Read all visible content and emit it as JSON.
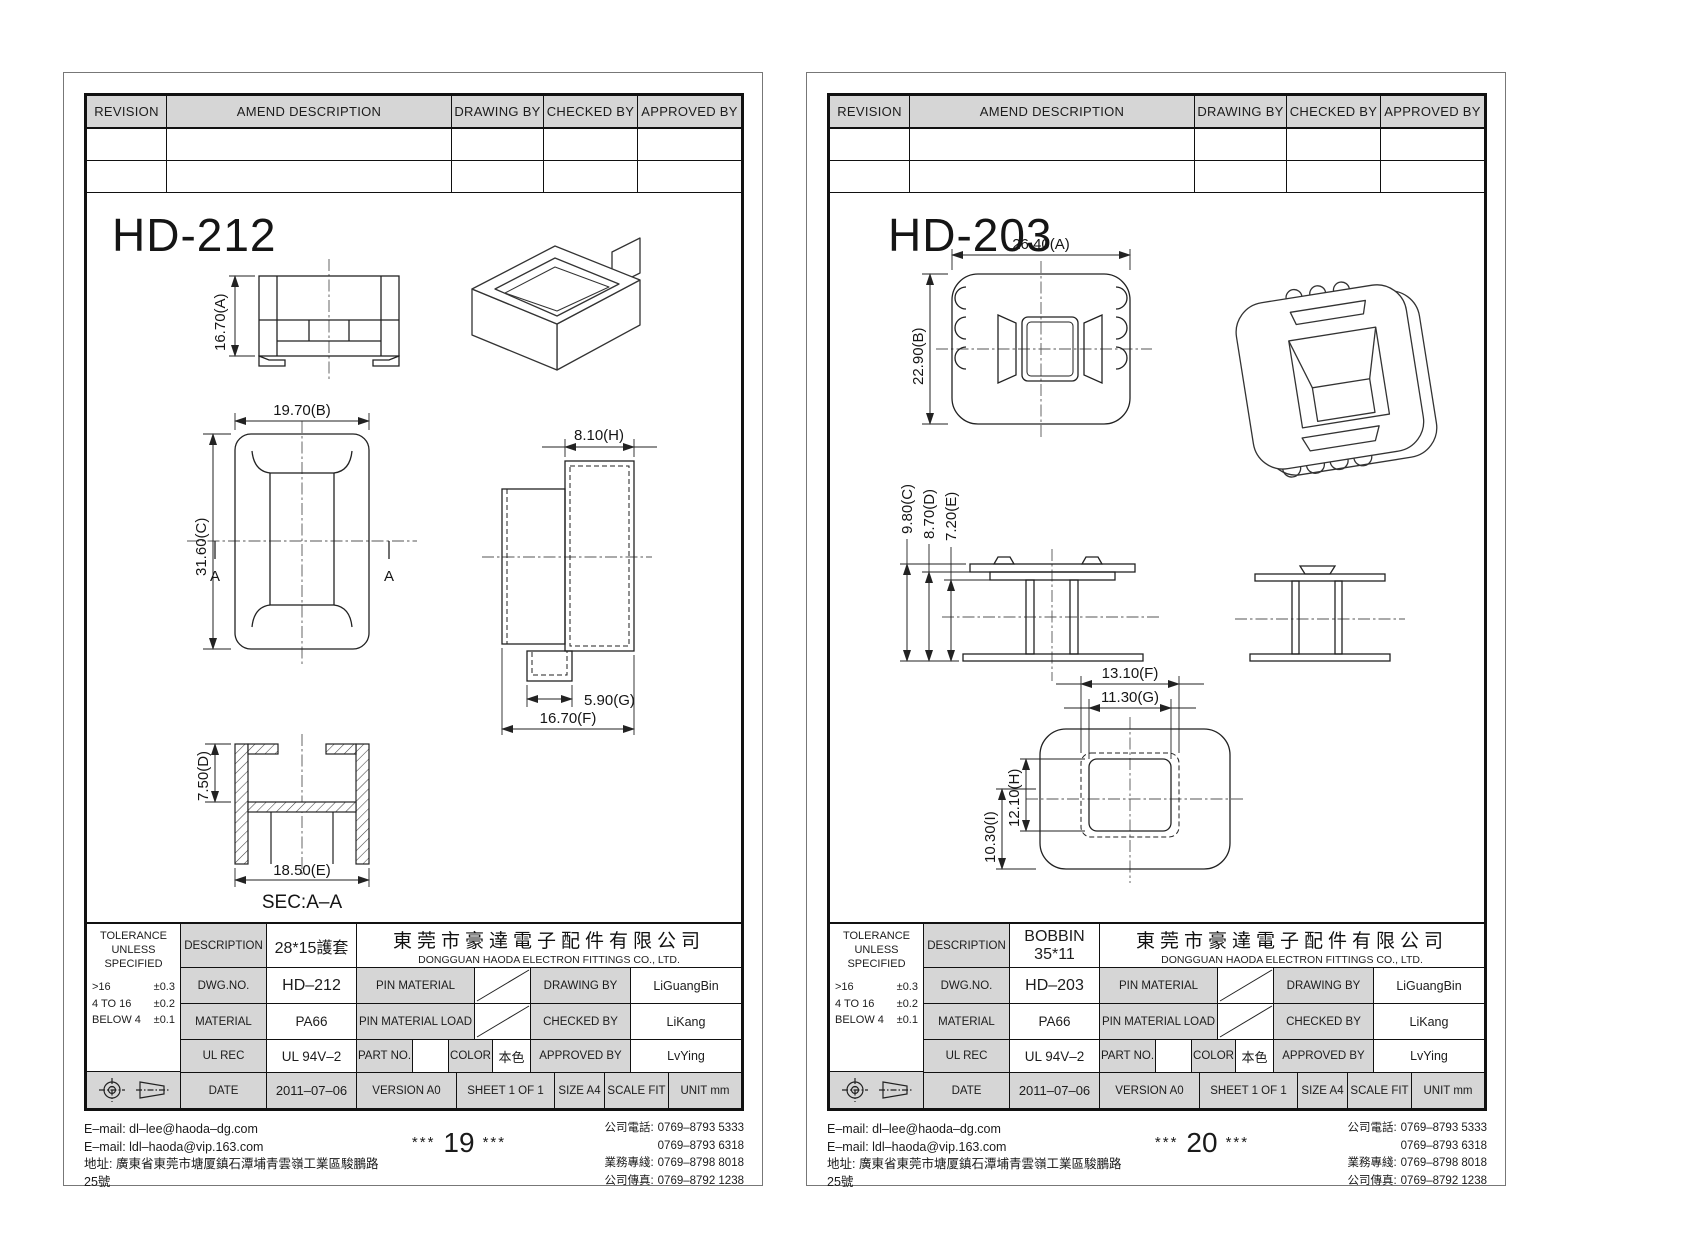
{
  "revision_header": {
    "cols": [
      "REVISION",
      "AMEND DESCRIPTION",
      "DRAWING BY",
      "CHECKED BY",
      "APPROVED BY"
    ]
  },
  "labels": {
    "tolerance1": "TOLERANCE",
    "tolerance2": "UNLESS",
    "tolerance3": "SPECIFIED",
    "tol_r1l": ">16",
    "tol_r1v": "±0.3",
    "tol_r2l": "4 TO 16",
    "tol_r2v": "±0.2",
    "tol_r3l": "BELOW 4",
    "tol_r3v": "±0.1",
    "description": "DESCRIPTION",
    "dwg_no": "DWG.NO.",
    "material": "MATERIAL",
    "ul_rec": "UL REC",
    "date": "DATE",
    "pin_material": "PIN MATERIAL",
    "pin_material_load": "PIN MATERIAL LOAD",
    "part_no": "PART NO.",
    "color": "COLOR",
    "drawing_by": "DRAWING BY",
    "checked_by": "CHECKED BY",
    "approved_by": "APPROVED BY",
    "version": "VERSION A0",
    "sheet_of": "SHEET 1 OF 1",
    "size": "SIZE A4",
    "scale": "SCALE FIT",
    "unit": "UNIT mm"
  },
  "company": {
    "cn": "東莞市豪達電子配件有限公司",
    "en": "DONGGUAN HAODA ELECTRON FITTINGS CO., LTD."
  },
  "footer": {
    "email1": "E–mail: dl–lee@haoda–dg.com",
    "email2": "E–mail: ldl–haoda@vip.163.com",
    "address": "地址: 廣東省東莞市塘厦鎮石潭埔青雲嶺工業區駿鵬路25號",
    "stars": "***",
    "tel_label": "公司電話:",
    "tel1": "0769–8793 5333",
    "tel2": "0769–8793 6318",
    "biz_label": "業務專綫:",
    "biz": "0769–8798 8018",
    "fax_label": "公司傳真:",
    "fax": "0769–8792 1238"
  },
  "sheets": [
    {
      "title": "HD-212",
      "page_number": "19",
      "description": "28*15護套",
      "dwg_no": "HD–212",
      "material": "PA66",
      "ul_rec": "UL 94V–2",
      "color": "本色",
      "date": "2011–07–06",
      "drawing_by": "LiGuangBin",
      "checked_by": "LiKang",
      "approved_by": "LvYing",
      "section_marker": "A",
      "section_label": "SEC:A–A",
      "dims": {
        "A": "16.70(A)",
        "B": "19.70(B)",
        "C": "31.60(C)",
        "D": "7.50(D)",
        "E": "18.50(E)",
        "F": "16.70(F)",
        "G": "5.90(G)",
        "H": "8.10(H)"
      }
    },
    {
      "title": "HD-203",
      "page_number": "20",
      "description": "BOBBIN 35*11",
      "dwg_no": "HD–203",
      "material": "PA66",
      "ul_rec": "UL 94V–2",
      "color": "本色",
      "date": "2011–07–06",
      "drawing_by": "LiGuangBin",
      "checked_by": "LiKang",
      "approved_by": "LvYing",
      "dims": {
        "A": "26.40(A)",
        "B": "22.90(B)",
        "C": "9.80(C)",
        "D": "8.70(D)",
        "E": "7.20(E)",
        "F": "13.10(F)",
        "G": "11.30(G)",
        "H": "12.10(H)",
        "I": "10.30(I)"
      }
    }
  ]
}
